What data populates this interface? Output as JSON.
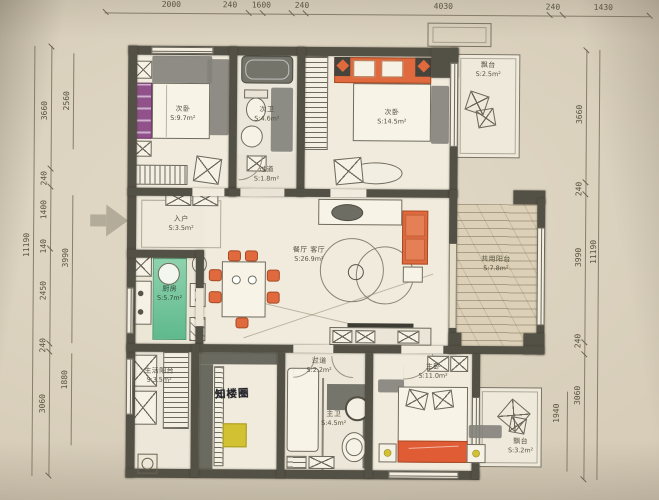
{
  "meta": {
    "kind": "hand-drawn apartment floor plan photo"
  },
  "colors": {
    "paper": "#d7cdb9",
    "wall": "#535046",
    "orange": "#e06a3d",
    "purple": "#91518a",
    "green": "#79c7a3",
    "yellow": "#d2c133",
    "dim_text": "#5a5442"
  },
  "dimensions": {
    "top": [
      "2000",
      "240",
      "1600",
      "240",
      "4030",
      "240",
      "1430"
    ],
    "left_outer": [
      "3660",
      "240",
      "1400",
      "140",
      "2450",
      "240",
      "3060"
    ],
    "left_inner": [
      "2560",
      "3990",
      "1880"
    ],
    "left_total": "11190",
    "right_outer": [
      "3660",
      "240",
      "3990",
      "240",
      "3060"
    ],
    "right_inner": [
      "1940"
    ],
    "right_total": "11190"
  },
  "rooms": [
    {
      "name": "次卧",
      "area": "S:9.7m²"
    },
    {
      "name": "次卫",
      "area": "S:4.6m²"
    },
    {
      "name": "过道",
      "area": "S:1.8m²"
    },
    {
      "name": "次卧",
      "area": "S:14.5m²"
    },
    {
      "name": "飘台",
      "area": "S:2.5m²"
    },
    {
      "name": "入户",
      "area": "S:3.5m²"
    },
    {
      "name": "厨房",
      "area": "S:5.7m²"
    },
    {
      "name": "餐厅 客厅",
      "area": "S:26.9m²"
    },
    {
      "name": "共用阳台",
      "area": "S:7.8m²"
    },
    {
      "name": "生活阳台",
      "area": "S:3.5m²"
    },
    {
      "name": "过道",
      "area": "S:2.2m²"
    },
    {
      "name": "主卫",
      "area": "S:4.5m²"
    },
    {
      "name": "主卧",
      "area": "S:11.0m²"
    },
    {
      "name": "飘台",
      "area": "S:3.2m²"
    }
  ],
  "watermark": "知楼圈"
}
